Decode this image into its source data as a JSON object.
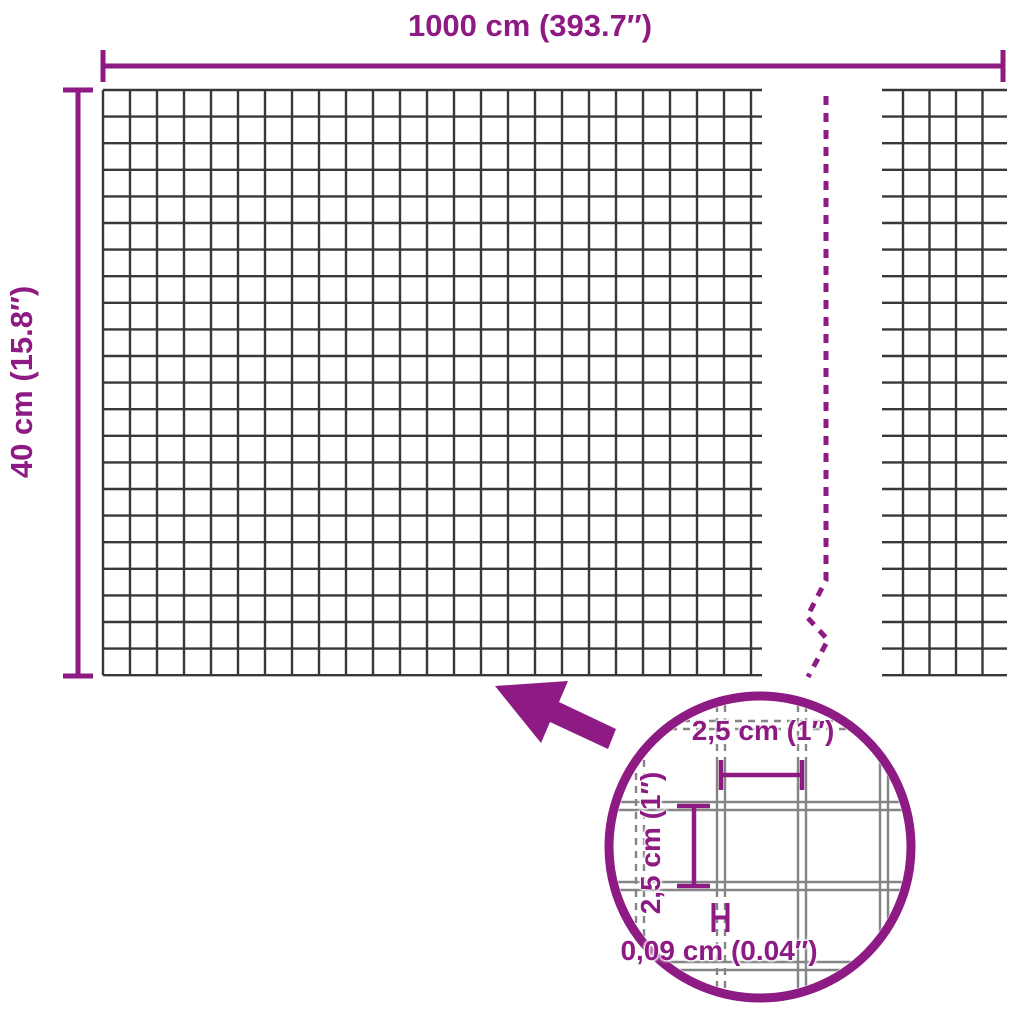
{
  "colors": {
    "accent": "#8E1A84",
    "mesh_line": "#383838",
    "zoom_mesh_line": "#858585",
    "background": "#FFFFFF"
  },
  "labels": {
    "width": "1000 cm (393.7″)",
    "height": "40 cm (15.8″)",
    "zoom_cell_width": "2,5 cm (1″)",
    "zoom_cell_height": "2,5 cm (1″)",
    "zoom_wire_thickness": "0,09 cm (0.04″)"
  },
  "diagram": {
    "overall_width": "1000 cm (393.7″)",
    "overall_height": "40 cm (15.8″)",
    "mesh_cell_width": "2,5 cm (1″)",
    "mesh_cell_height": "2,5 cm (1″)",
    "wire_thickness": "0,09 cm (0.04″)"
  }
}
